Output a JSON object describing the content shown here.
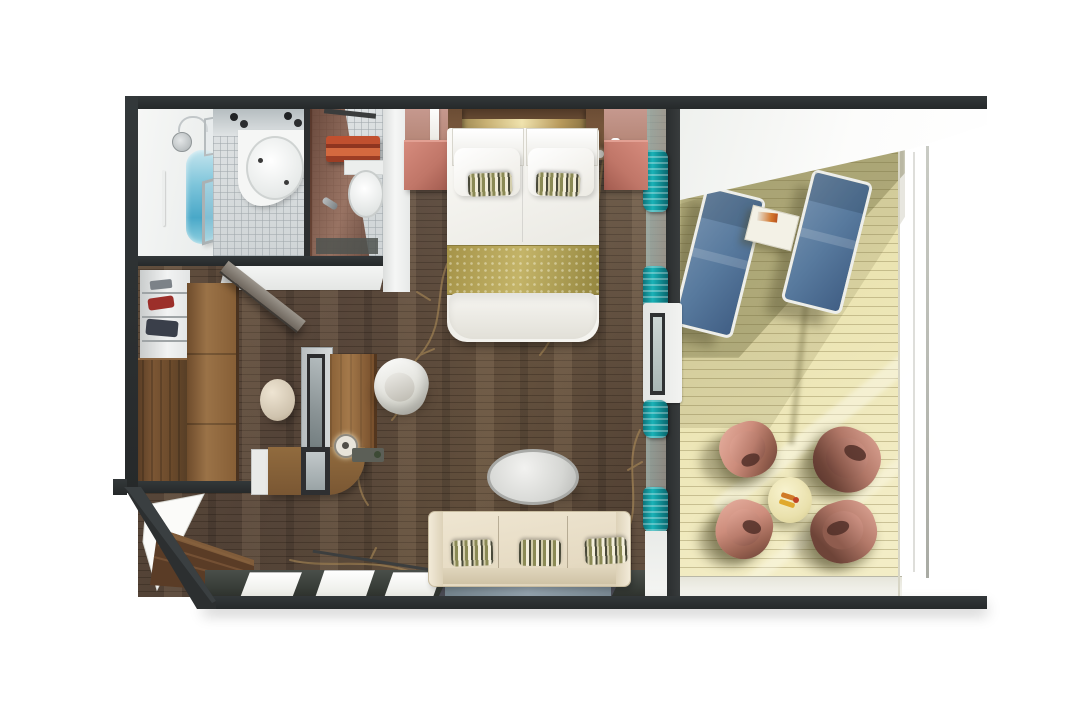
{
  "page": {
    "background": "#ffffff"
  },
  "floorplan": {
    "kind": "3D top-down cutaway rendering of a suite floor plan",
    "setting": "cruise-ship style stateroom with private balcony",
    "aria_label": "Top-down 3D floor plan of a suite with bathroom, wardrobe, bedroom, desk, living area and furnished balcony",
    "rooms": [
      {
        "name": "bathroom",
        "position": "top-left",
        "features": [
          "walk-in shower tub with blue water",
          "overhead shower",
          "glass partition",
          "round washbasin",
          "vanity spotlights",
          "toilet",
          "red towel rack",
          "dark bath mat",
          "grey tiled floor"
        ]
      },
      {
        "name": "entry-and-wardrobe",
        "position": "left-middle",
        "features": [
          "open shelving with folded clothes",
          "dark wooden wardrobe",
          "open wardrobe door",
          "entry door ajar"
        ]
      },
      {
        "name": "bedroom",
        "position": "top-center",
        "features": [
          "double bed with white duvet",
          "two white pillows",
          "two striped accent pillows",
          "gold patterned bed runner",
          "wood headboard with gold trim",
          "two salmon nightstands",
          "hanging white towels"
        ]
      },
      {
        "name": "work-area",
        "position": "center",
        "features": [
          "dressing desk with dark framed mirror",
          "wooden desktop",
          "white shell chair",
          "round cream stool",
          "table lamp",
          "curved wooden return desk",
          "dark desk tray"
        ]
      },
      {
        "name": "living-area",
        "position": "bottom-center",
        "features": [
          "cream three-seat sofa",
          "three olive striped cushions",
          "oval glass coffee table",
          "blue-grey runner rug",
          "windows along lower wall",
          "angled corner bench"
        ]
      },
      {
        "name": "balcony",
        "position": "right",
        "features": [
          "pale timber decking",
          "two blue sun loungers",
          "small white side table",
          "round cream drinks table",
          "four rose tub chairs",
          "glass balustrade",
          "white deckhead overhang",
          "teal curtains beside sliding door"
        ]
      }
    ],
    "palette": {
      "wall_dark": "#2c2f30",
      "floor_wood": "#5a4738",
      "floor_streak": "#d8ba94",
      "vine_gold": "#b2905a",
      "deck": "#ebe4b2",
      "deck_shadow": "#6e6a3c",
      "lounger_blue": "#587a9e",
      "lounger_frame": "#edeeea",
      "curtain_teal": "#1ab2b7",
      "nightstand_salmon": "#c97f72",
      "headboard_gold": "#e8d9a4",
      "bed_white": "#f3f2ee",
      "runner_gold": "#b1a256",
      "sofa_cream": "#e9dfc9",
      "pillow_olive": "#8b8a55",
      "rug_blue": "#8292a0",
      "chair_rose": "#cd8d7c",
      "drinks_table_cream": "#e9e0ae",
      "tub_water": "#7cc4da",
      "tile_grey": "#d7dbdd",
      "towel_red": "#c1502f",
      "wardrobe_wood": "#7b5634",
      "desk_wood": "#8a6137"
    }
  }
}
